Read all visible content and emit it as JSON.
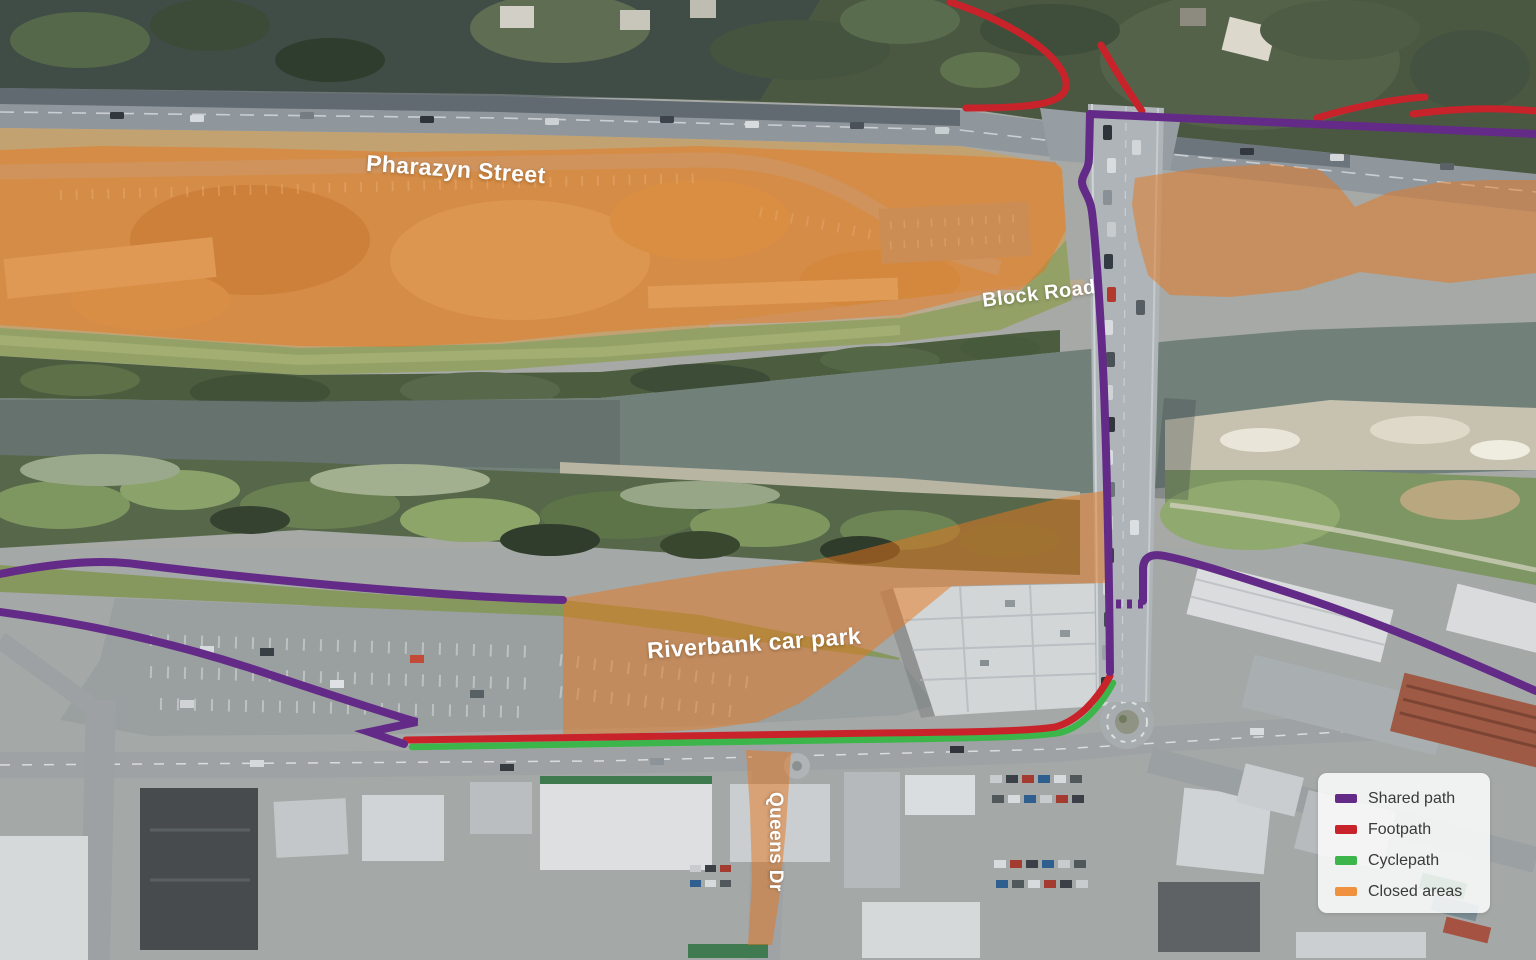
{
  "map": {
    "labels": {
      "pharazyn": "Pharazyn Street",
      "block": "Block Road",
      "riverbank": "Riverbank car park",
      "queens": "Queens Dr"
    },
    "closed_area_fill": "#e8761c"
  },
  "legend": {
    "items": [
      {
        "key": "shared-path",
        "label": "Shared path",
        "color": "#632b87"
      },
      {
        "key": "footpath",
        "label": "Footpath",
        "color": "#c8232b"
      },
      {
        "key": "cyclepath",
        "label": "Cyclepath",
        "color": "#3cb54a"
      },
      {
        "key": "closed-areas",
        "label": "Closed areas",
        "color": "#f0913f"
      }
    ]
  }
}
